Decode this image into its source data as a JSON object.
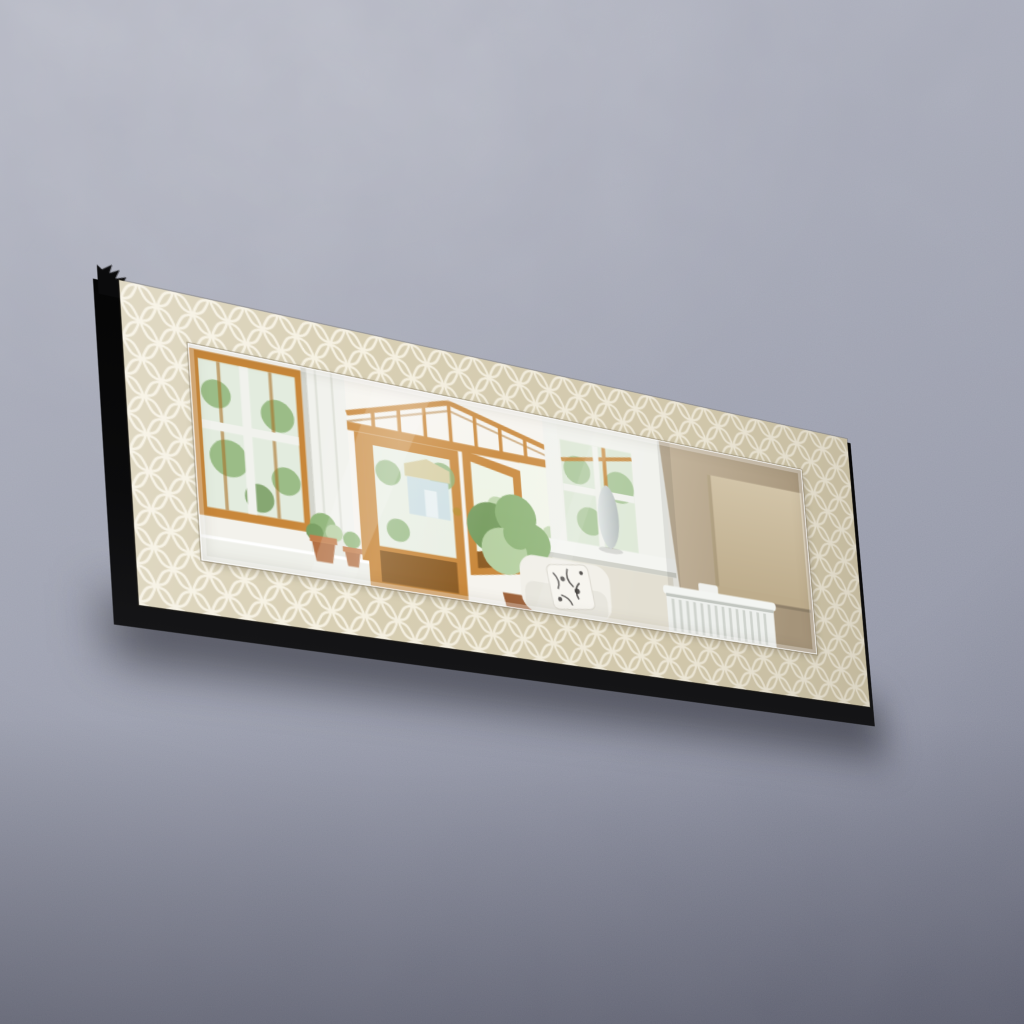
{
  "scene": {
    "type": "product-photograph",
    "description": "Decorative rectangular wall mirror with a cream quatrefoil-trellis patterned frame and black box sides, hung tilted (left end higher and nearer) on a bare gray concrete wall. The mirror reflects a conservatory interior: golden-oak framed windows and an open french door, a glass gable roof, garden greenery, potted plants, a white sofa with a black-and-white floral cushion, a white sash window with a pale ceramic vase on its sill, a taupe interior wall, a beige roller blind and a white panel radiator.",
    "subject": "framed wall mirror",
    "background": "bare concrete plaster wall",
    "frame_pattern": "white quatrefoil (moroccan trellis) outlines on beige",
    "orientation": "landscape mirror rotated about 12 degrees clockwise with perspective depth on left and bottom"
  },
  "reflection": {
    "elements": [
      "oak-framed window with foliage behind glass",
      "white frame column",
      "conservatory gable roof with oak rafters and toplights",
      "oak french door, one leaf open, brass handle",
      "pale blue garden building with thatched roof",
      "small potted tree",
      "terracotta plant pots on white ledge",
      "white sofa with black-and-white floral cushion",
      "white sash window",
      "pale gray-blue vase on white windowsill",
      "taupe interior wall",
      "beige roller blind with bottom bar",
      "white panel radiator with fins"
    ]
  },
  "colors": {
    "wall_top": "#b7bac6",
    "wall_mid": "#9da1b0",
    "wall_bottom": "#7f8396",
    "frame_base": "#d8cfb4",
    "frame_pattern_line": "#f6f1e2",
    "box_side": "#0b0b0c",
    "glass_tint": "#f3f2ec",
    "oak": "#c8873a",
    "oak_dark": "#a96f26",
    "oak_panel": "#8a5a22",
    "white_frame": "#f1f2ed",
    "foliage": "#8fb478",
    "foliage_dark": "#769c5f",
    "foliage_light": "#b5cfa0",
    "shed_blue": "#cfe0e4",
    "thatch": "#d8cfa4",
    "taupe_wall_light": "#c6b79f",
    "taupe_wall_dark": "#a5947a",
    "blind": "#d2c4a8",
    "blind_dark": "#bdac8c",
    "radiator": "#eef0ed",
    "radiator_line": "#cfd3cd",
    "vase_light": "#e0e5e4",
    "vase_dark": "#b7bebd",
    "terracotta": "#b06a3c",
    "sofa": "#f1efe8",
    "cushion_print": "#2e2b28",
    "trunk": "#7d5c3e",
    "shadow": "rgba(8,8,14,0.5)"
  }
}
